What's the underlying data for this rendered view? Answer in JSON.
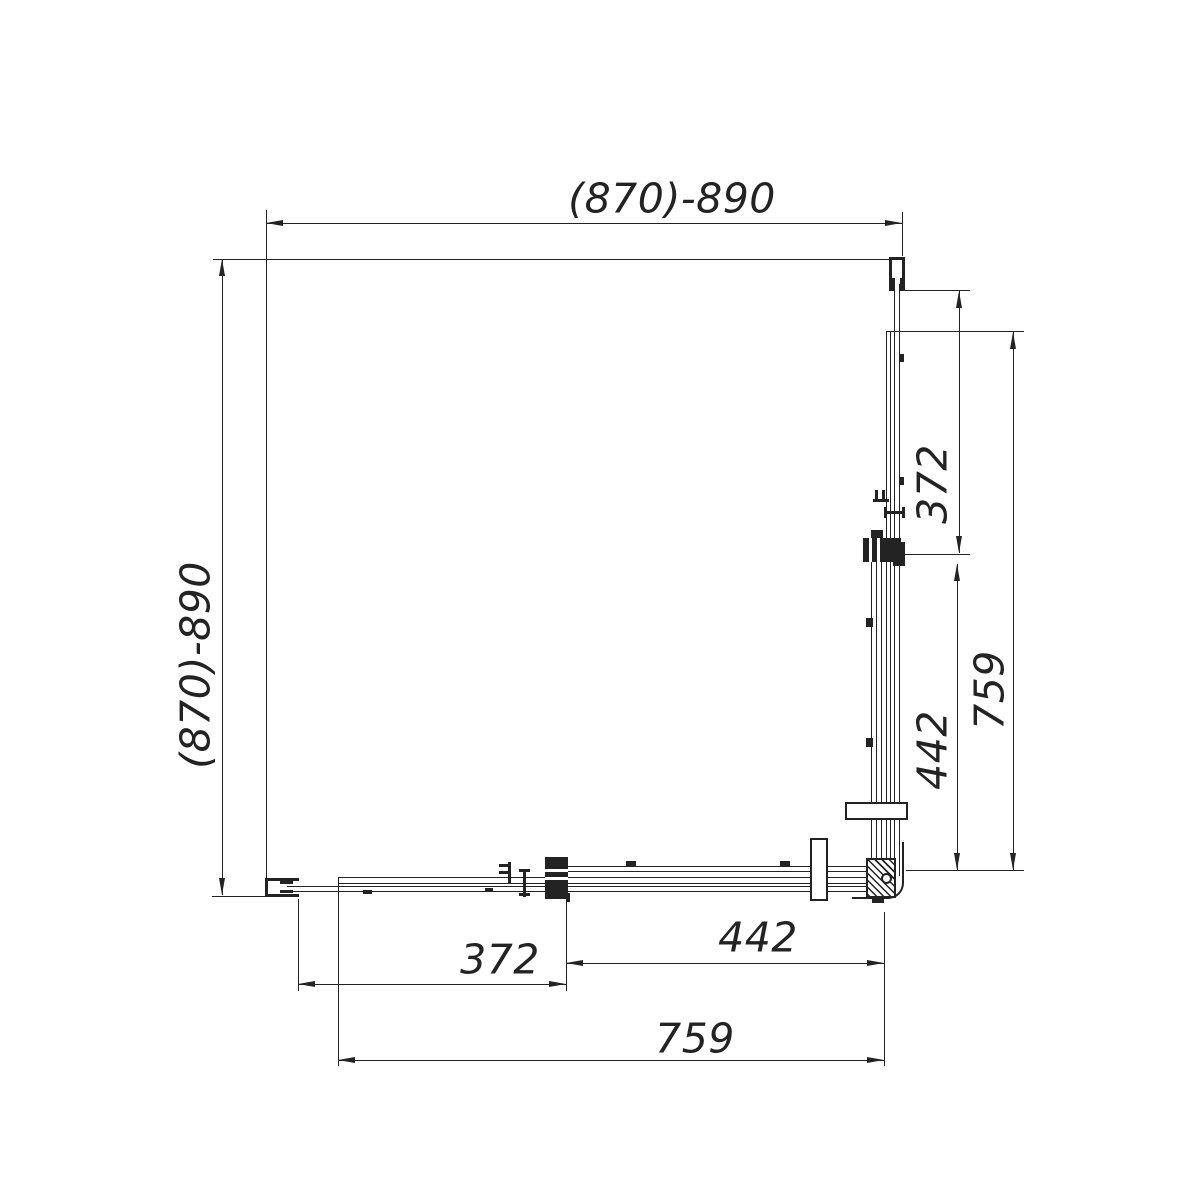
{
  "drawing": {
    "dimensions": {
      "top": "(870)-890",
      "left": "(870)-890",
      "right": [
        "372",
        "442",
        "759"
      ],
      "bottom": [
        "372",
        "442",
        "759"
      ]
    },
    "colors": {
      "background": "#ffffff",
      "line": "#232323"
    }
  }
}
